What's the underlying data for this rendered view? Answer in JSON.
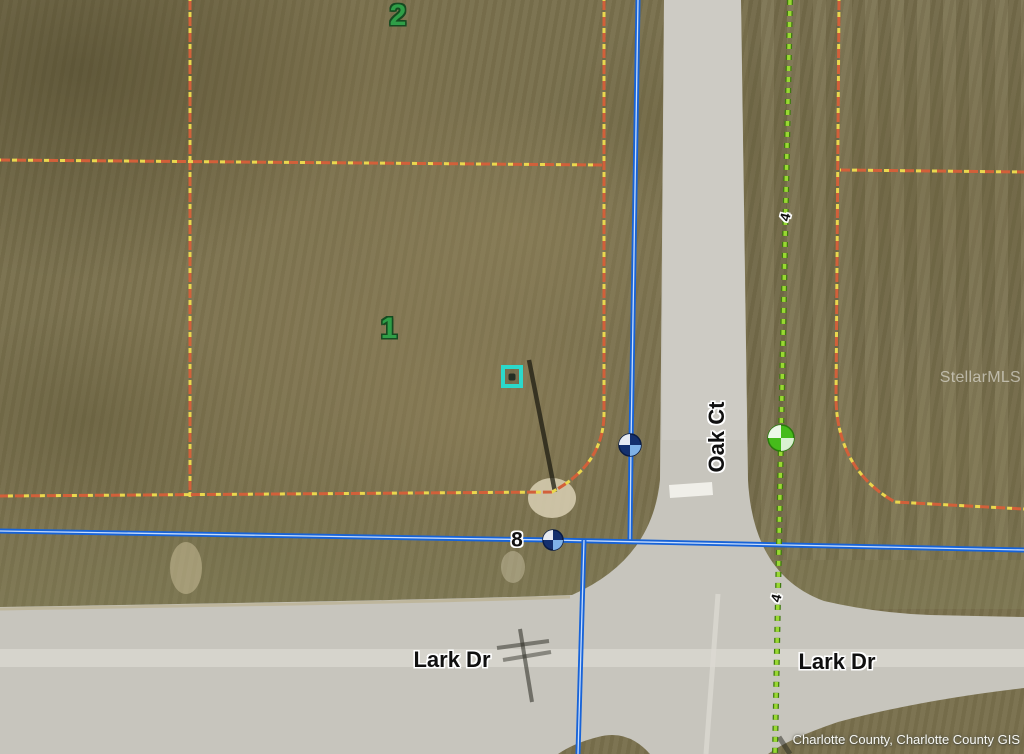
{
  "map": {
    "parcel_labels": {
      "lot1": "1",
      "lot2": "2",
      "lot8": "8"
    },
    "street_labels": {
      "oak_ct": "Oak Ct",
      "lark_dr_west": "Lark Dr",
      "lark_dr_east": "Lark Dr"
    },
    "utility_labels": {
      "top": "4",
      "bottom": "4"
    },
    "watermark": "StellarMLS",
    "attribution": "Charlotte County, Charlotte County GIS",
    "colors": {
      "grass_base": "#79704d",
      "road_pavement": "#c7c5bd",
      "parcel_boundary_orange": "#d2603a",
      "parcel_boundary_yellow": "#ead74e",
      "street_centerline_blue": "#1763d8",
      "utility_line_green": "#8ccb2a",
      "street_node_navy": "#14306e",
      "utility_node_green": "#46bb1b",
      "parcel_number_green": "#2f9e47",
      "property_marker_teal": "#2bd9cb"
    },
    "icons": {
      "property_marker": "teal-square-property-marker",
      "street_node_marker": "blue-quadrant-circle-marker",
      "utility_node_marker": "green-quadrant-circle-marker"
    }
  }
}
